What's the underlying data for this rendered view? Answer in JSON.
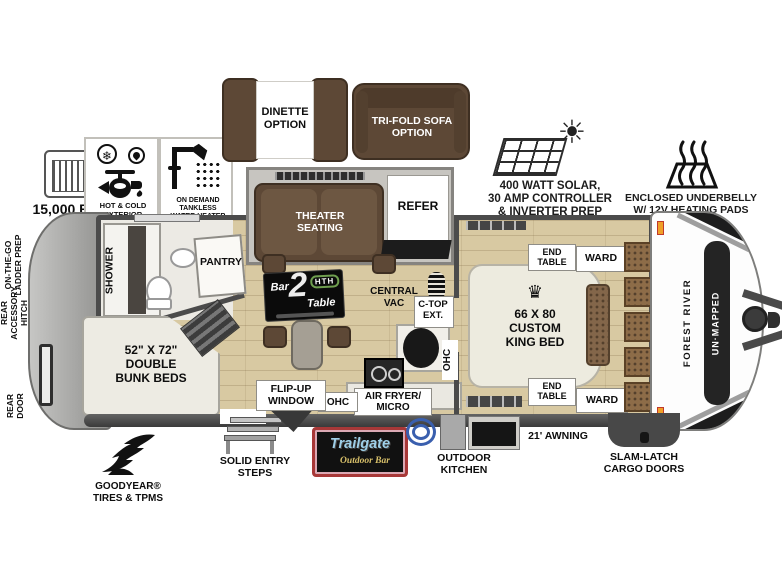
{
  "title": "Forest River Un-Mapped travel trailer floorplan",
  "feature_callouts": {
    "ac": "15,000 BTU AC",
    "spray_port": "HOT & COLD EXTERIOR\nSPRAY PORT",
    "water_heater": "ON DEMAND\nTANKLESS\nWATER HEATER",
    "solar": "400 WATT SOLAR,\n30 AMP CONTROLLER\n& INVERTER PREP",
    "underbelly": "ENCLOSED UNDERBELLY\nW/ 12V HEATING PADS",
    "goodyear": "GOODYEAR®\nTIRES & TPMS",
    "entry_steps": "SOLID ENTRY\nSTEPS",
    "outdoor_kitchen": "OUTDOOR\nKITCHEN",
    "awning": "21' AWNING",
    "cargo_doors": "SLAM-LATCH\nCARGO DOORS",
    "ladder_prep": "ON-THE-GO\nLADDER PREP",
    "rear_hitch": "REAR\nACCESSORY\nHITCH",
    "rear_door": "REAR\nDOOR"
  },
  "options": {
    "dinette": "DINETTE\nOPTION",
    "trifold_sofa": "TRI-FOLD SOFA\nOPTION"
  },
  "rooms": {
    "shower": "SHOWER",
    "pantry": "PANTRY",
    "bunk_beds": "52\" X 72\"\nDOUBLE\nBUNK BEDS",
    "theater_seating": "THEATER\nSEATING",
    "refer": "REFER",
    "central_vac": "CENTRAL\nVAC",
    "ctop_ext": "C-TOP\nEXT.",
    "flip_up_window": "FLIP-UP\nWINDOW",
    "ohc_galley": "OHC",
    "ohc_vertical": "OHC",
    "air_fryer": "AIR FRYER/\nMICRO",
    "king_bed": "66 X 80\nCUSTOM\nKING BED",
    "crown_glyph": "♛",
    "end_table_front": "END\nTABLE",
    "ward_front": "WARD",
    "end_table_rear": "END\nTABLE",
    "ward_rear": "WARD"
  },
  "logos": {
    "bar2table_bar": "Bar",
    "bar2table_num": "2",
    "bar2table_table": "Table",
    "bar2table_hth": "HTH",
    "tailgate_name": "Trailgate",
    "tailgate_sub": "Outdoor Bar",
    "brand_maker": "FOREST RIVER",
    "brand_model": "UN·MAPPED"
  },
  "icons": {
    "cold_glyph": "❄",
    "sun_glyph": "☀"
  },
  "colors": {
    "floor_tan": "#d8c9a2",
    "wall_gray": "#4b4b4b",
    "furniture_brown": "#5d4836",
    "hth_green": "#6f9e4f",
    "trailgate_blue": "#9ecfe8",
    "trailgate_yellow": "#d8c06a",
    "trailgate_red": "#a83838",
    "marker_light_orange": "#f0a028"
  }
}
